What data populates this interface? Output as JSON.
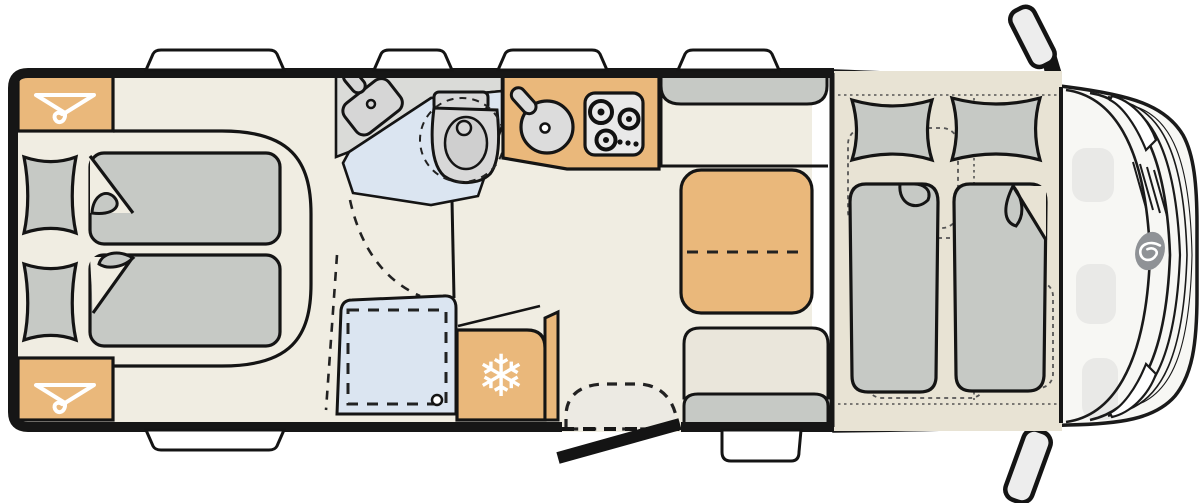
{
  "colors": {
    "background": "#ffffff",
    "wall": "#161616",
    "floor": "#f0ede2",
    "bed_zone": "#e8e3d4",
    "cab_floor": "#f7f7f4",
    "furniture_orange": "#eab87b",
    "furniture_gray": "#c6c9c5",
    "counter_gray": "#dadbd8",
    "panel_gray": "#e9e9e9",
    "wet_blue": "#dbe5f1",
    "window_white": "#ffffff",
    "logo_gray": "#8f9296",
    "mirror_gray": "#ededed",
    "step_gray": "#eceae3",
    "dash_line": "#3c3c3c"
  },
  "icons": {
    "snowflake": "❄",
    "hanger": "hanger-icon"
  },
  "components": {
    "rear_bedroom": "twin-single-beds",
    "wardrobes": 2,
    "washroom": "basin-and-swivel-toilet",
    "shower": "shower-tray",
    "kitchen": "round-sink-and-3-burner-hob",
    "refrigerator": "fridge",
    "dinette": "table-with-facing-benches",
    "entrance": "door-with-entry-step",
    "cab": "drop-down-bed-over-cab-seats",
    "roof_windows": 4,
    "mirrors": 2
  }
}
